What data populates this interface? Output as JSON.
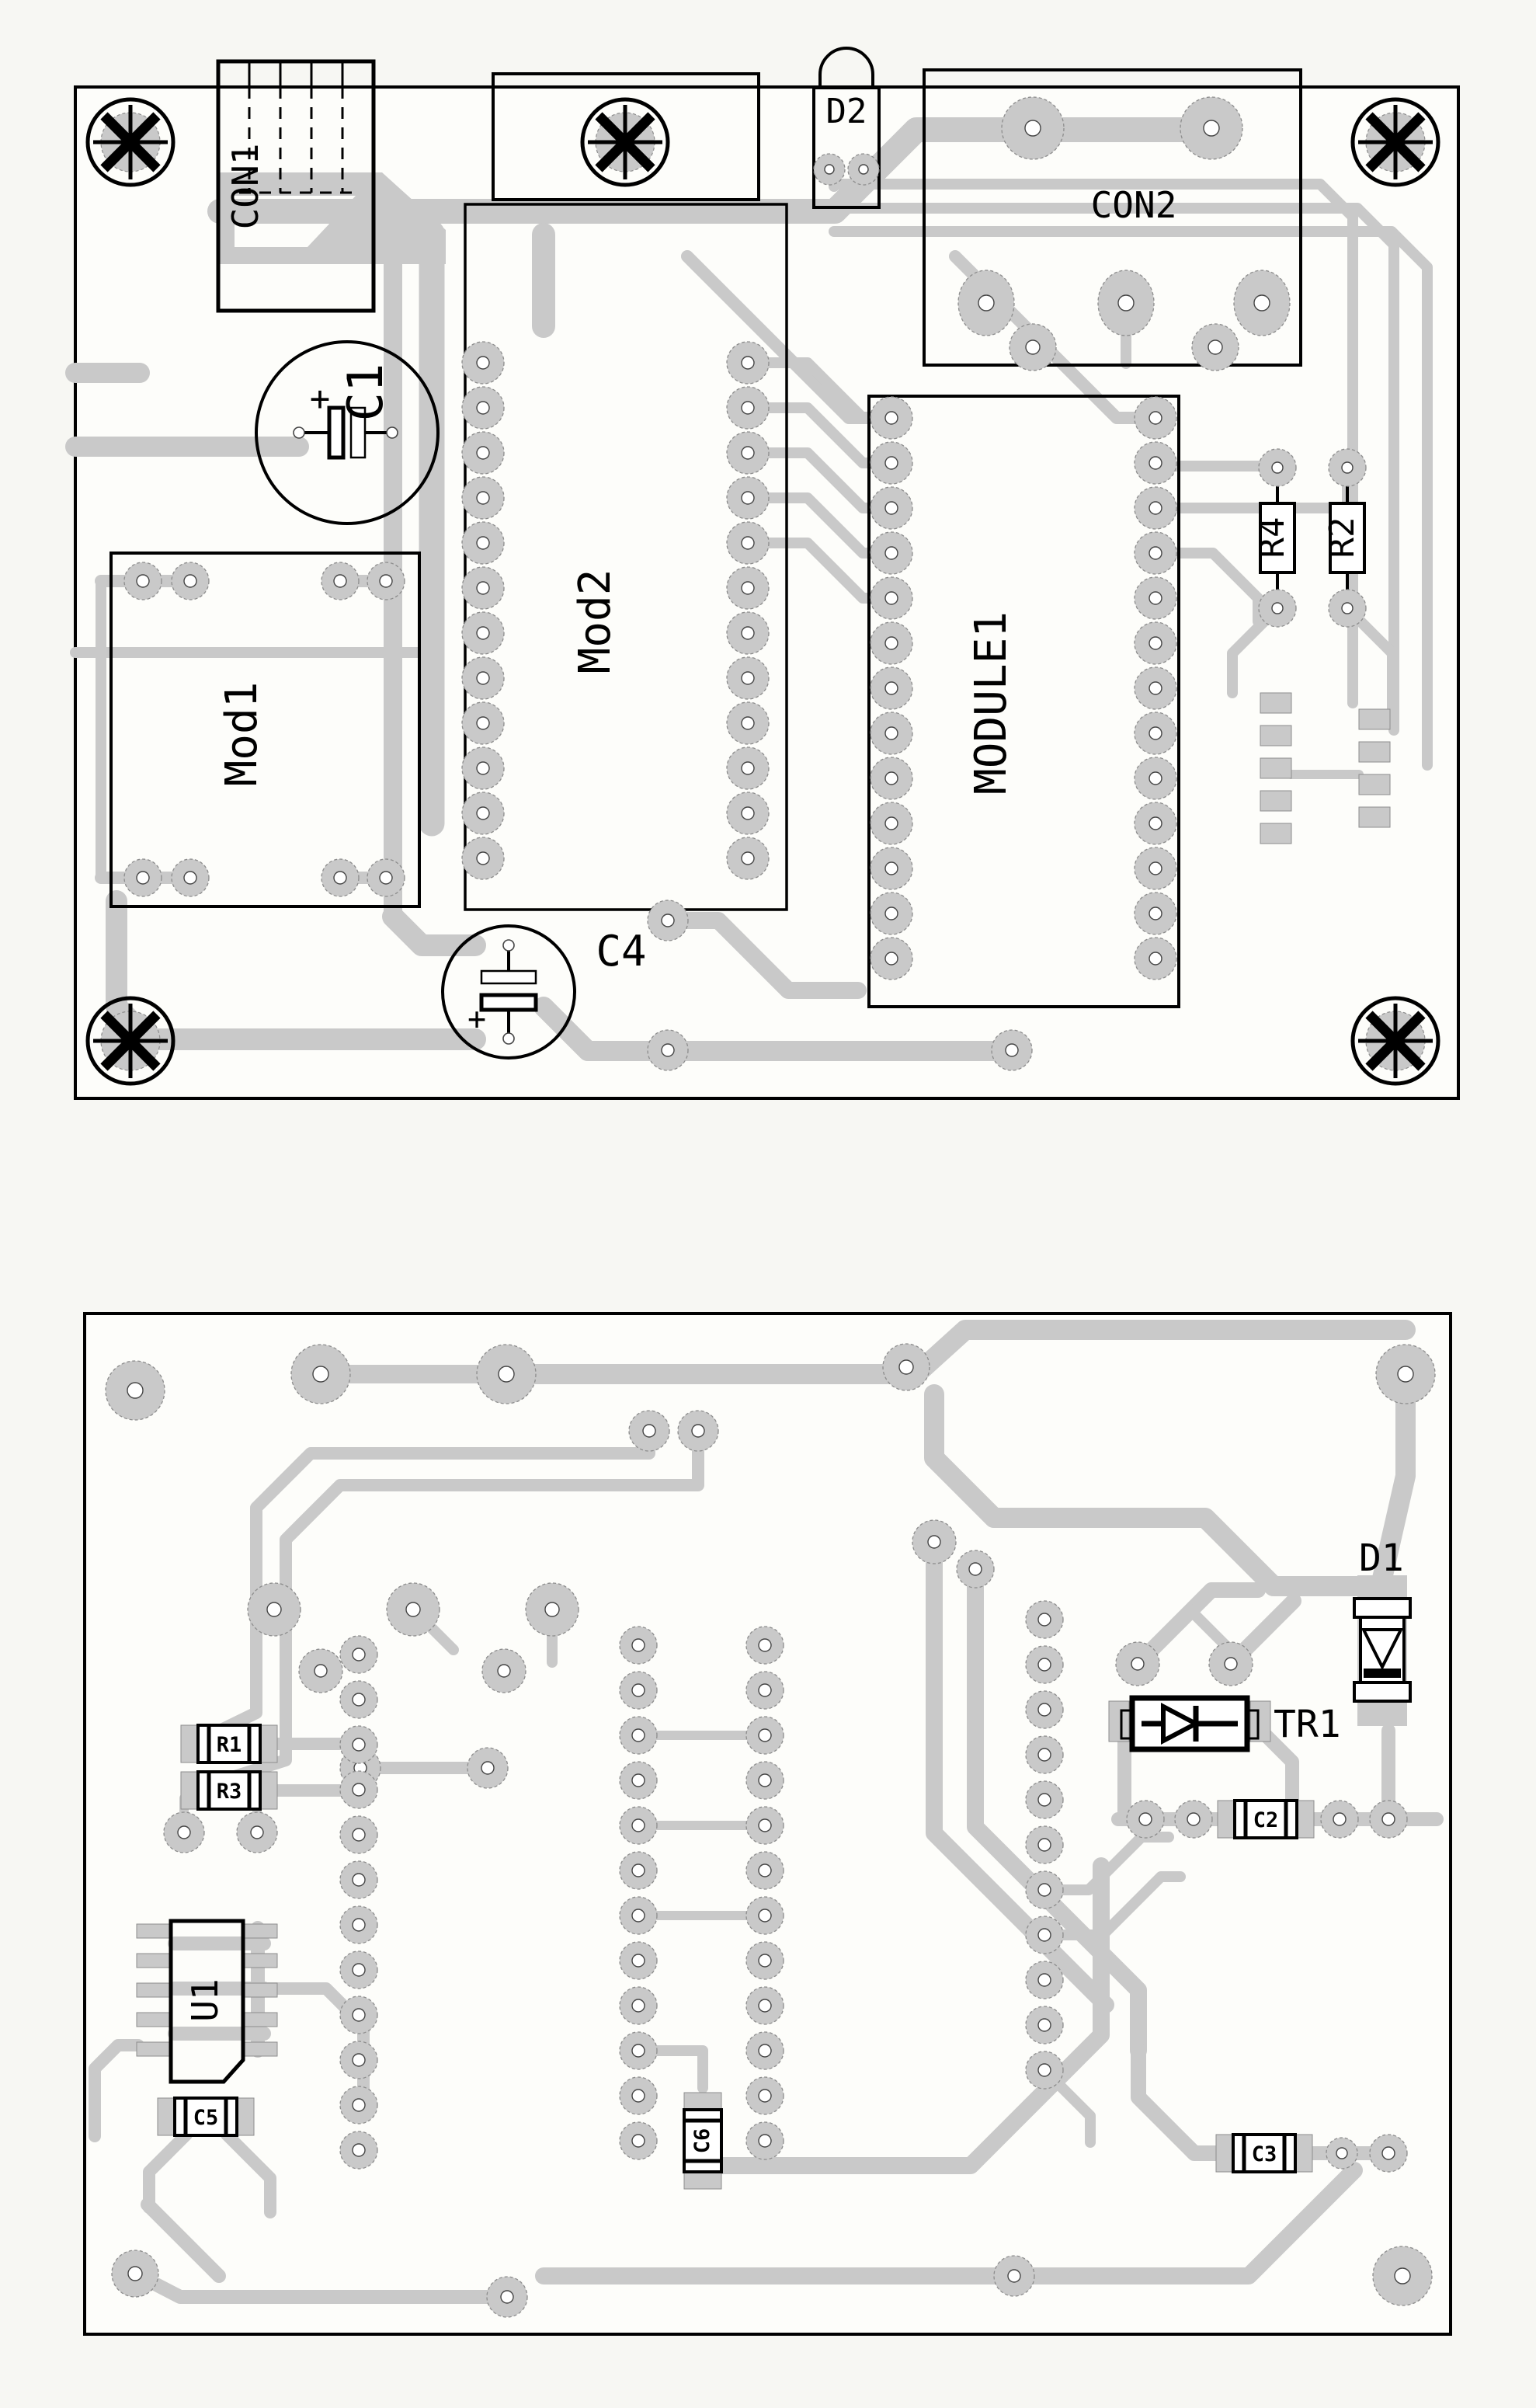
{
  "colors": {
    "trace": "#c9c9c9",
    "outline": "#000000",
    "board_fill": "#fdfdfa",
    "page_background": "#f7f7f3",
    "hole": "#ffffff",
    "pad_stroke": "#8d8d8d"
  },
  "top_board": {
    "labels": {
      "con1": "CON1",
      "d2": "D2",
      "con2": "CON2",
      "c1": "C1",
      "c1_plus": "+",
      "mod1": "Mod1",
      "mod2": "Mod2",
      "module1": "MODULE1",
      "r4": "R4",
      "r2": "R2",
      "c4": "C4",
      "c4_plus": "+"
    }
  },
  "bottom_board": {
    "labels": {
      "r1": "R1",
      "r3": "R3",
      "u1": "U1",
      "c5": "C5",
      "c6": "C6",
      "c2": "C2",
      "c3": "C3",
      "tr1": "TR1",
      "d1": "D1"
    }
  }
}
